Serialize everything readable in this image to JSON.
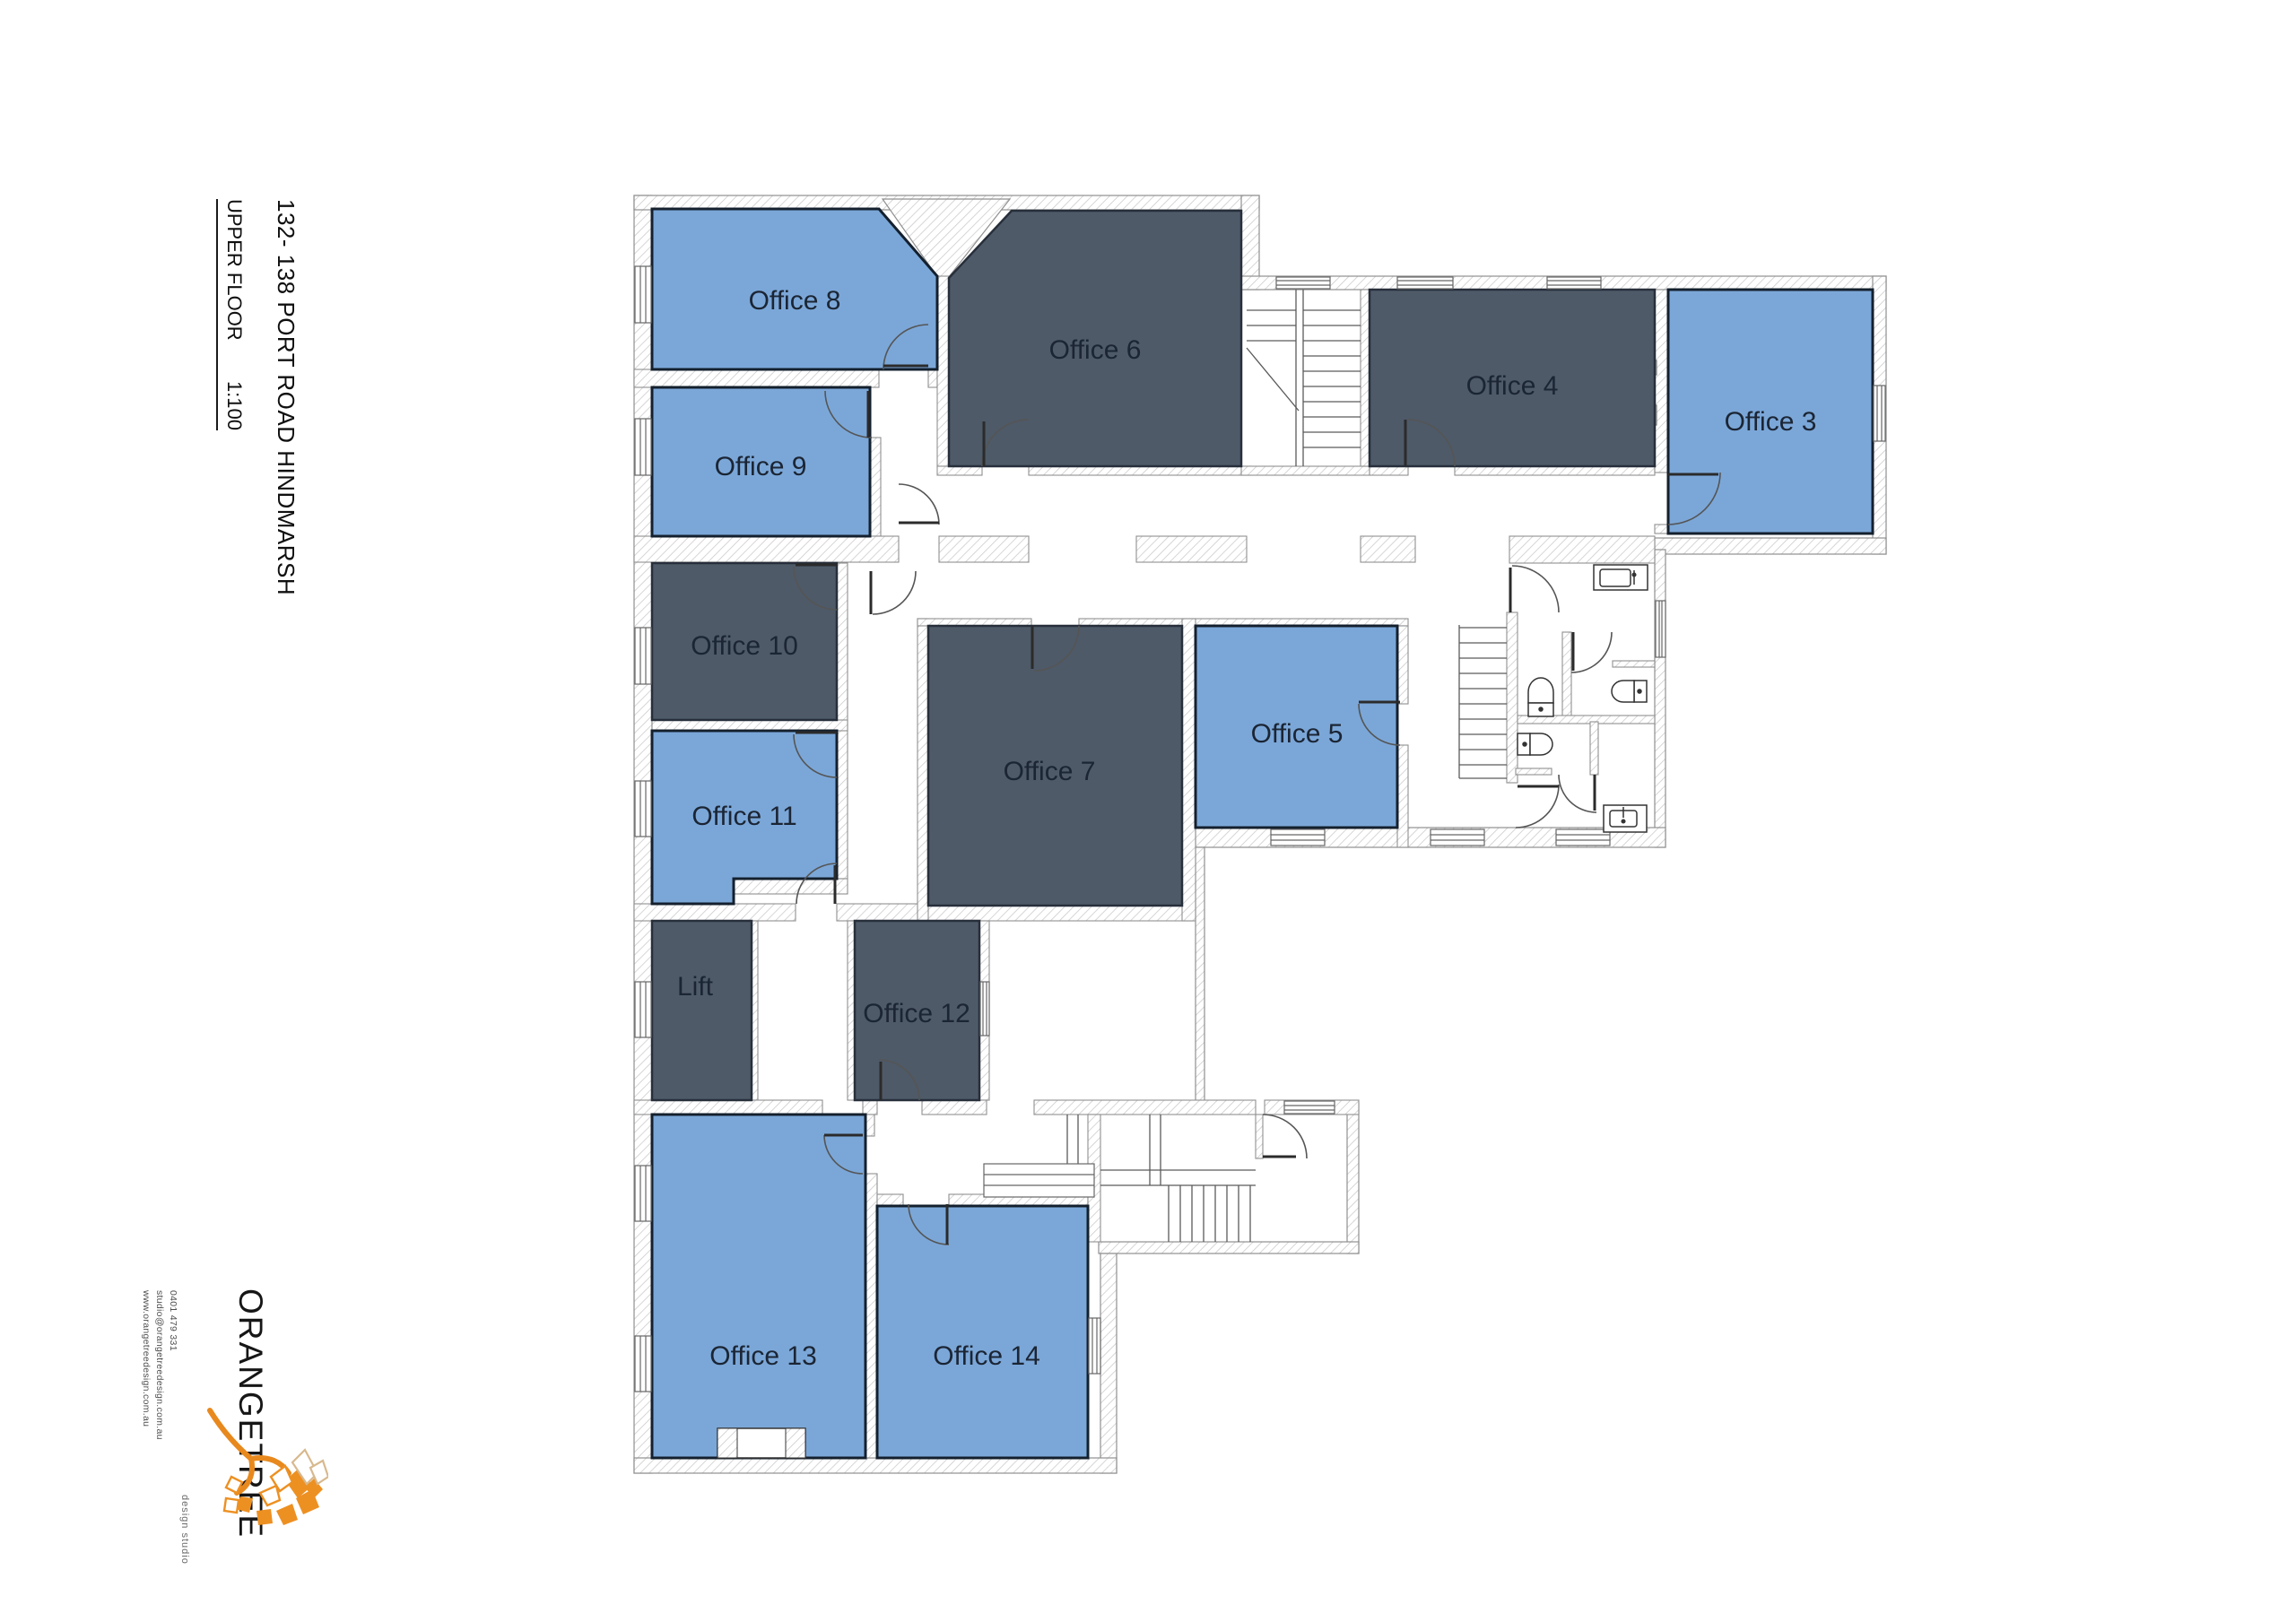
{
  "title": {
    "address": "132- 138 PORT ROAD HINDMARSH",
    "floor": "UPPER FLOOR",
    "scale": "1:100"
  },
  "logo": {
    "name": "ORANGETREE",
    "tagline": "design studio",
    "phone": "0401 479 331",
    "email": "studio@orangetreedesign.com.au",
    "website": "www.orangetreedesign.com.au"
  },
  "colors": {
    "room_blue": "#7BA7D8",
    "room_dark": "#4E5A68",
    "room_blue_border": "#14202E",
    "room_dark_border": "#272F3B",
    "label": "#1B2534",
    "accent_orange": "#E8891E"
  },
  "rooms": {
    "office3": {
      "label": "Office 3"
    },
    "office4": {
      "label": "Office 4"
    },
    "office5": {
      "label": "Office 5"
    },
    "office6": {
      "label": "Office 6"
    },
    "office7": {
      "label": "Office 7"
    },
    "office8": {
      "label": "Office 8"
    },
    "office9": {
      "label": "Office 9"
    },
    "office10": {
      "label": "Office 10"
    },
    "office11": {
      "label": "Office 11"
    },
    "office12": {
      "label": "Office 12"
    },
    "office13": {
      "label": "Office 13"
    },
    "office14": {
      "label": "Office 14"
    },
    "lift": {
      "label": "Lift"
    }
  }
}
